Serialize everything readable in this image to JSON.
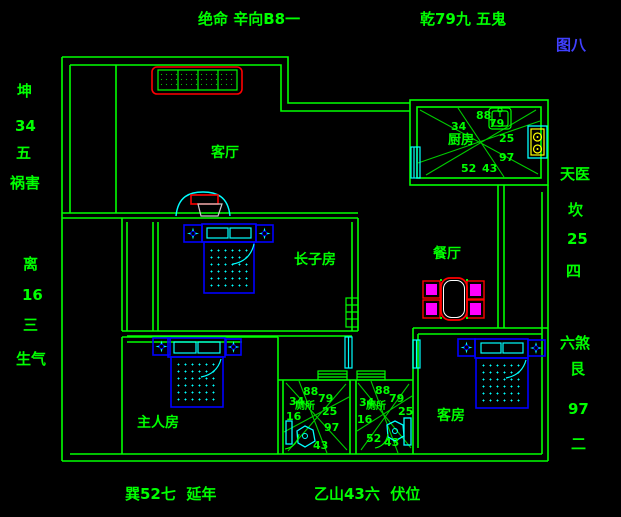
{
  "figure": {
    "label": "图八"
  },
  "annotations": {
    "top_center": "绝命 辛向B8一",
    "top_right": "乾79九 五鬼",
    "bottom_left": "巽52七  延年",
    "bottom_center": "乙山43六  伏位",
    "left_upper": [
      "坤",
      "34",
      "五",
      "祸害"
    ],
    "left_lower": [
      "离",
      "16",
      "三",
      "生气"
    ],
    "right_upper": [
      "天医",
      "坎",
      "25",
      "四"
    ],
    "right_lower": [
      "六煞",
      "艮",
      "97",
      "二"
    ]
  },
  "rooms": {
    "living_room": "客厅",
    "eldest_son_room": "长子房",
    "master_room": "主人房",
    "dining_room": "餐厅",
    "guest_room": "客房",
    "kitchen": "厨房",
    "bathroom_left": "厕所",
    "bathroom_right": "厕所"
  },
  "compass": {
    "kitchen": {
      "upper_left": "34",
      "top": "88",
      "upper_right": "79",
      "right": "25",
      "lower_right": "97",
      "bottom": "43",
      "lower_left": "52"
    },
    "bath_left": {
      "top": "88",
      "upper_left": "34",
      "upper_right": "79",
      "left": "16",
      "right": "25",
      "lower_right": "97",
      "bottom": "43"
    },
    "bath_right": {
      "top": "88",
      "upper_left": "34",
      "upper_right": "79",
      "right": "25",
      "left": "16",
      "lower_left": "52",
      "bottom": "43"
    }
  },
  "colors": {
    "background": "#000000",
    "wall": "#00ff00",
    "furniture_primary": "#0000ff",
    "furniture_accent": "#00ffff",
    "highlight": "#ff0000",
    "chair_fill": "#ff00ff",
    "stove": "#ffff00",
    "figure_label": "#4040ff"
  }
}
